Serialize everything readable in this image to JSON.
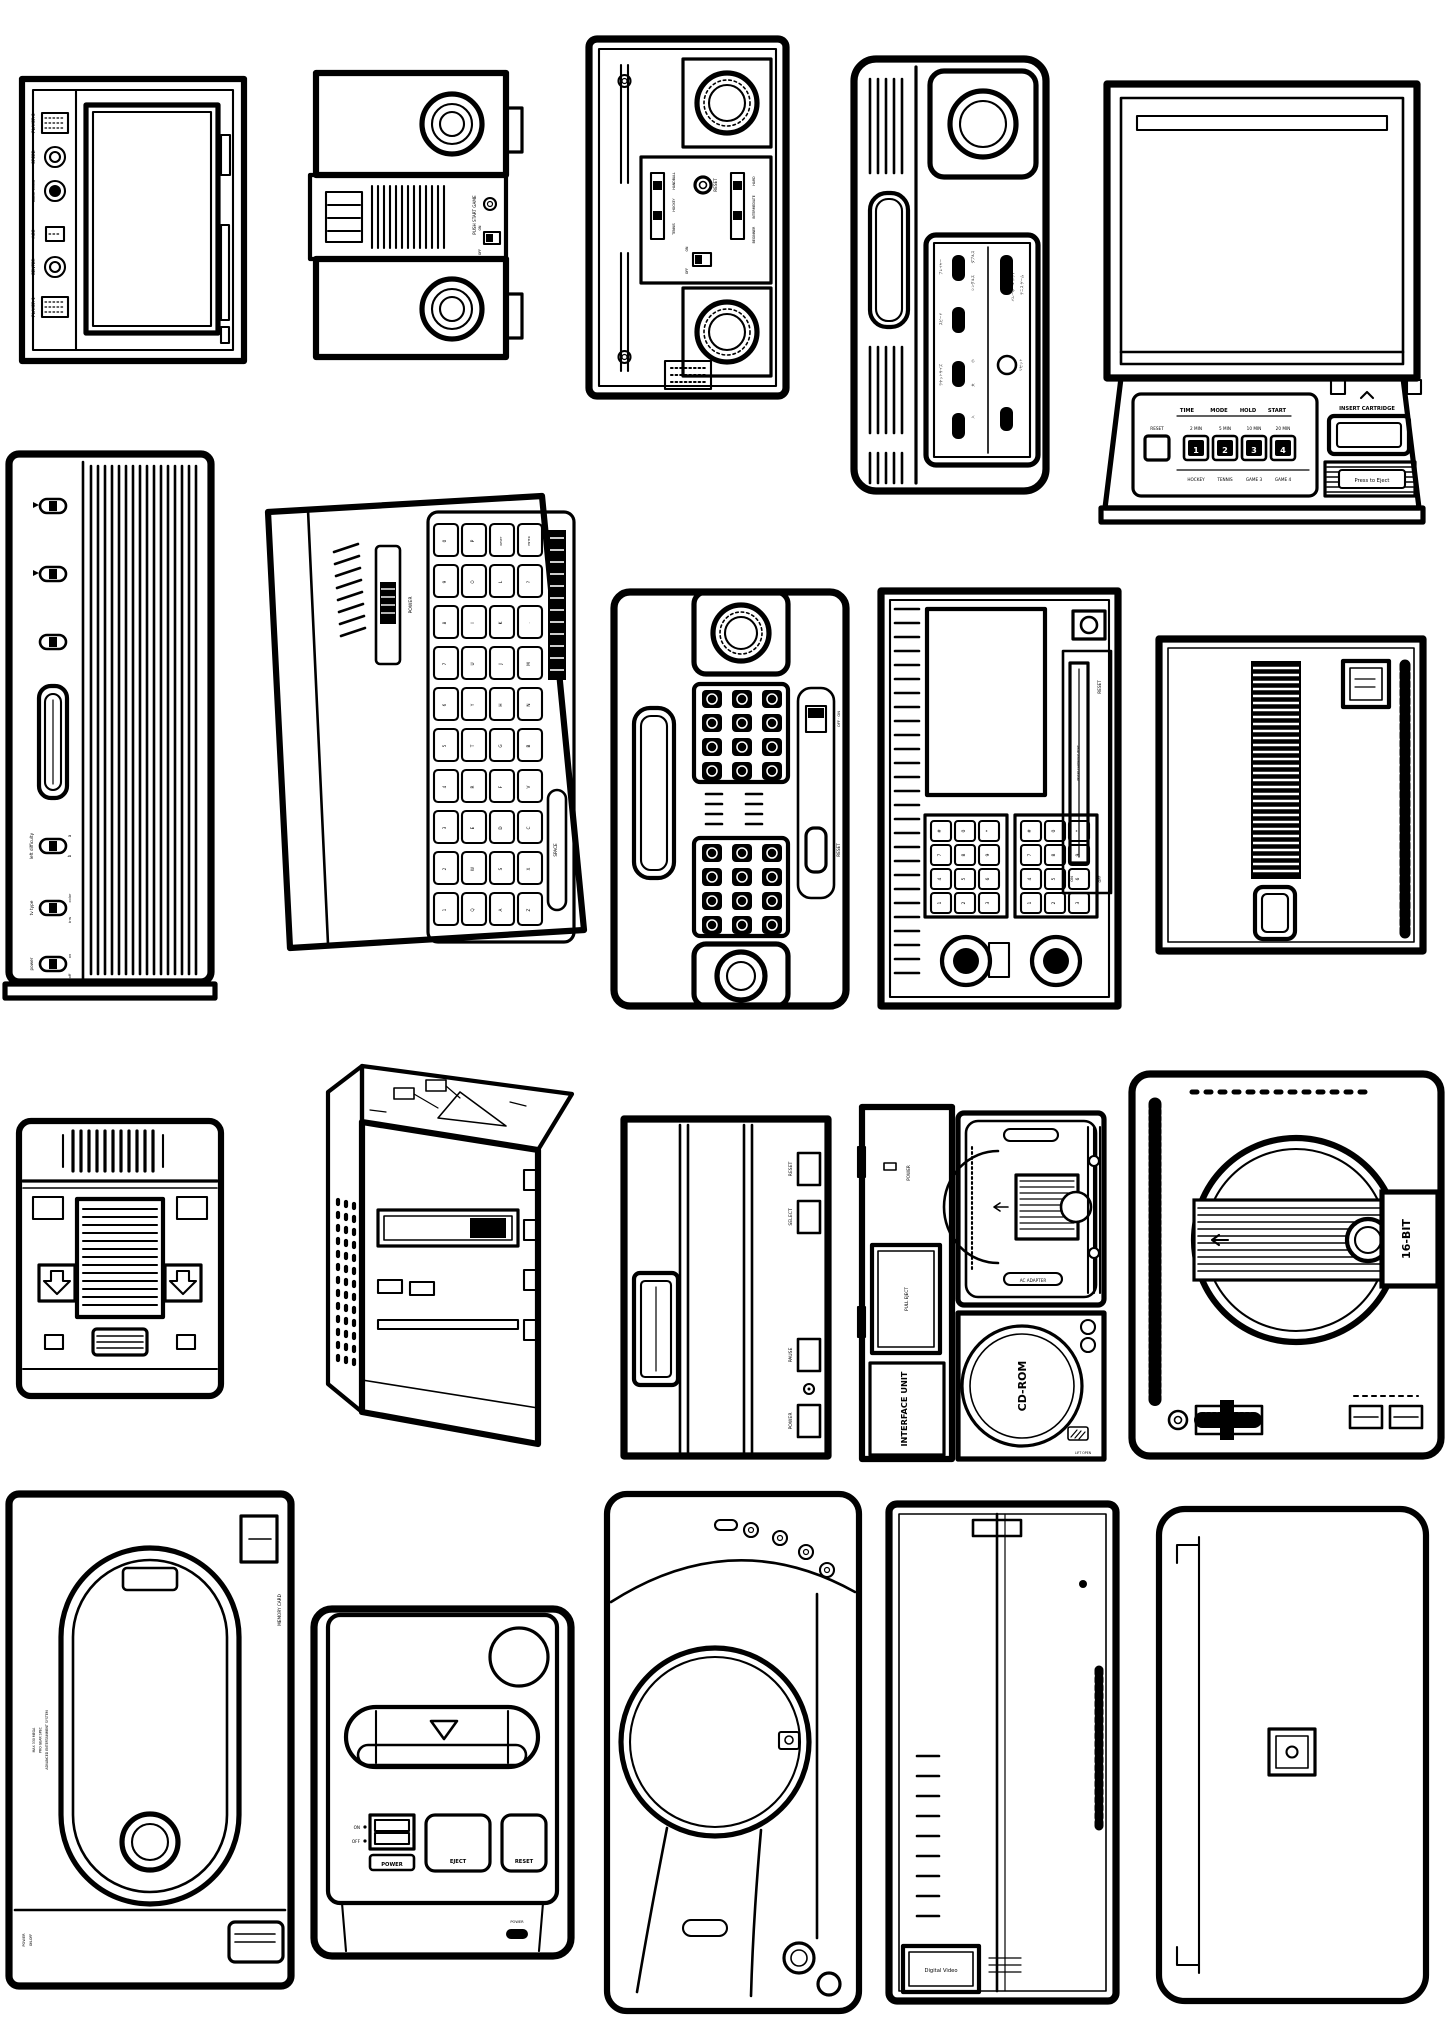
{
  "poster": {
    "background": "#ffffff",
    "ink": "#000000"
  },
  "consoles": {
    "odyssey": {
      "labels": {
        "player2": "PLAYER 2",
        "speed": "SPEED",
        "game_cord": "GAME CORD",
        "acc": "ACC",
        "center": "CENTER",
        "player1": "PLAYER 1"
      }
    },
    "pong": {
      "labels": {
        "push_start_game": "PUSH START GAME",
        "on": "ON",
        "off": "OFF"
      }
    },
    "telstar": {
      "labels": {
        "tennis": "TENNIS",
        "hockey": "HOCKEY",
        "handball": "HANDBALL",
        "reset": "RESET",
        "hard": "HARD",
        "intermediate": "INTERMEDIATE",
        "beginner": "BEGINNER",
        "on": "ON",
        "off": "OFF"
      }
    },
    "color_tv_game": {
      "labels": {
        "player": "プレイヤー",
        "doubles": "ダブルス",
        "singles": "シングルス",
        "speed": "スピード",
        "racket_size": "ラケットサイズ",
        "small": "小",
        "large": "大",
        "volleyball_hockey": "バレーボール ホッケー",
        "tennis_game": "テニス ゲーム",
        "reset": "リセット",
        "power_on": "入"
      }
    },
    "cassette_vision": {
      "labels": {
        "time": "TIME",
        "mode": "MODE",
        "hold": "HOLD",
        "start": "START",
        "reset": "RESET",
        "min2": "2 MIN",
        "min5": "5 MIN",
        "min10": "10 MIN",
        "min20": "20 MIN",
        "b1": "1",
        "b2": "2",
        "b3": "3",
        "b4": "4",
        "hockey": "HOCKEY",
        "tennis": "TENNIS",
        "game3": "GAME 3",
        "game4": "GAME 4",
        "insert_cartridge": "INSERT CARTRIDGE",
        "press_to_eject": "Press to Eject"
      }
    },
    "atari_2600": {
      "labels": {
        "left_difficulty": "left difficulty",
        "a": "a",
        "b": "b",
        "tv_type": "tv type",
        "color": "color",
        "bw": "b·w",
        "power": "power",
        "on": "on",
        "off": "off"
      }
    },
    "keyboard_console": {
      "labels": {
        "power": "POWER",
        "space": "SPACE"
      },
      "key_columns": [
        [
          "0",
          "9",
          "8",
          "7",
          "6",
          "5",
          "4",
          "3",
          "2",
          "1"
        ],
        [
          "P",
          "O",
          "I",
          "U",
          "Y",
          "T",
          "R",
          "E",
          "W",
          "Q"
        ],
        [
          "RESET",
          "L",
          "K",
          "J",
          "H",
          "G",
          "F",
          "D",
          "S",
          "A"
        ],
        [
          "ENTER",
          "?",
          ".",
          "M",
          "N",
          "B",
          "V",
          "C",
          "X",
          "Z"
        ]
      ]
    },
    "twin_keypad": {
      "labels": {
        "off_on": "OFF · ON",
        "reset": "RESET"
      }
    },
    "cartridge_keypad": {
      "labels": {
        "insert": "INSERT CARTRIDGE HERE",
        "reset": "RESET",
        "on": "ON",
        "off": "OFF"
      },
      "keypad_rows": [
        [
          "#",
          "0",
          "*"
        ],
        [
          "7",
          "8",
          "9"
        ],
        [
          "4",
          "5",
          "6"
        ],
        [
          "1",
          "2",
          "3"
        ]
      ]
    },
    "striped_console": {
      "labels": {}
    },
    "famicom": {
      "labels": {}
    },
    "perspective_console": {
      "labels": {}
    },
    "master_system": {
      "labels": {
        "reset": "RESET",
        "select": "SELECT",
        "pause": "PAUSE",
        "power": "POWER"
      }
    },
    "interface_unit": {
      "labels": {
        "unit": "INTERFACE UNIT",
        "pull_eject": "PULL EJECT",
        "power": "POWER",
        "ac_adapter": "AC ADAPTER",
        "cd_rom": "CD-ROM",
        "lift_open": "LIFT OPEN"
      }
    },
    "mega_drive": {
      "labels": {
        "bit16": "16-BIT"
      }
    },
    "neo_geo": {
      "labels": {
        "memory_card": "MEMORY CARD",
        "spec1": "MAX 330 MEGA",
        "spec2": "PRO GEAR SPEC",
        "spec3": "ADVANCED ENTERTAINMENT SYSTEM",
        "power": "POWER",
        "on_off": "ON-OFF"
      }
    },
    "super_famicom": {
      "labels": {
        "on": "ON",
        "off": "OFF",
        "power": "POWER",
        "eject": "EJECT",
        "reset": "RESET",
        "power_led": "POWER"
      }
    },
    "cd_round": {
      "labels": {}
    },
    "cd_i": {
      "labels": {
        "digital_video": "Digital Video"
      }
    },
    "plain_box": {
      "labels": {}
    }
  }
}
